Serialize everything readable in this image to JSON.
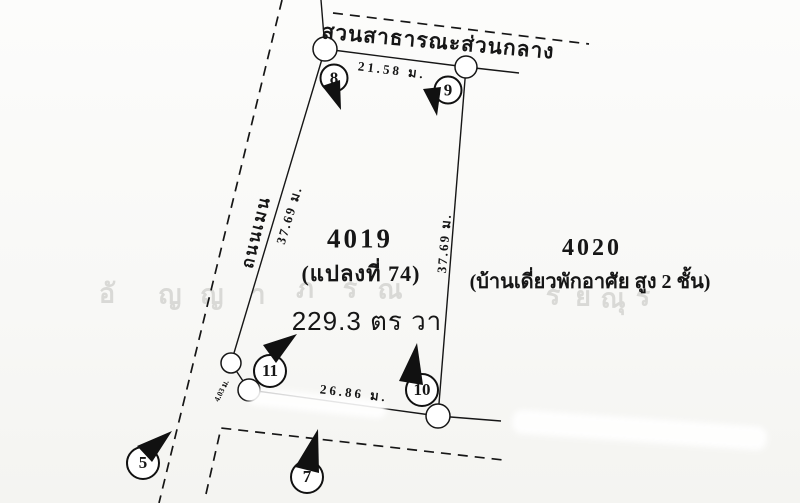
{
  "diagram": {
    "park_label": "สวนสาธารณะส่วนกลาง",
    "road_label": "ถนนเมน",
    "plot": {
      "number": "4019",
      "parcel": "(แปลงที่ 74)",
      "area": "229.3 ตร วา"
    },
    "adjacent_plot": {
      "number": "4020",
      "description": "(บ้านเดี่ยวพักอาศัย สูง 2 ชั้น)"
    },
    "measurements": {
      "top_edge": "21.58 ม.",
      "left_edge": "37.69 ม.",
      "right_edge": "37.69 ม.",
      "bottom_edge": "26.86 ม.",
      "corner_jog": "4.03 ม."
    },
    "boundary_markers": {
      "m5": "5",
      "m7": "7",
      "m8": "8",
      "m9": "9",
      "m10": "10",
      "m11": "11"
    },
    "watermark": {
      "chars": [
        {
          "ch": "อั",
          "x": 107,
          "y": 293
        },
        {
          "ch": "ญ",
          "x": 170,
          "y": 294
        },
        {
          "ch": "ญ",
          "x": 212,
          "y": 294
        },
        {
          "ch": "า",
          "x": 258,
          "y": 294
        },
        {
          "ch": "ภ",
          "x": 305,
          "y": 288
        },
        {
          "ch": "ร",
          "x": 350,
          "y": 288
        },
        {
          "ch": "ณ",
          "x": 390,
          "y": 289
        },
        {
          "ch": "ร",
          "x": 553,
          "y": 295
        },
        {
          "ch": "ย",
          "x": 583,
          "y": 296
        },
        {
          "ch": "ณุ",
          "x": 613,
          "y": 298
        },
        {
          "ch": "ร",
          "x": 643,
          "y": 296
        }
      ]
    },
    "colors": {
      "ink": "#161616",
      "paper": "#fafaf8",
      "watermark": "#d9d9d6"
    }
  }
}
